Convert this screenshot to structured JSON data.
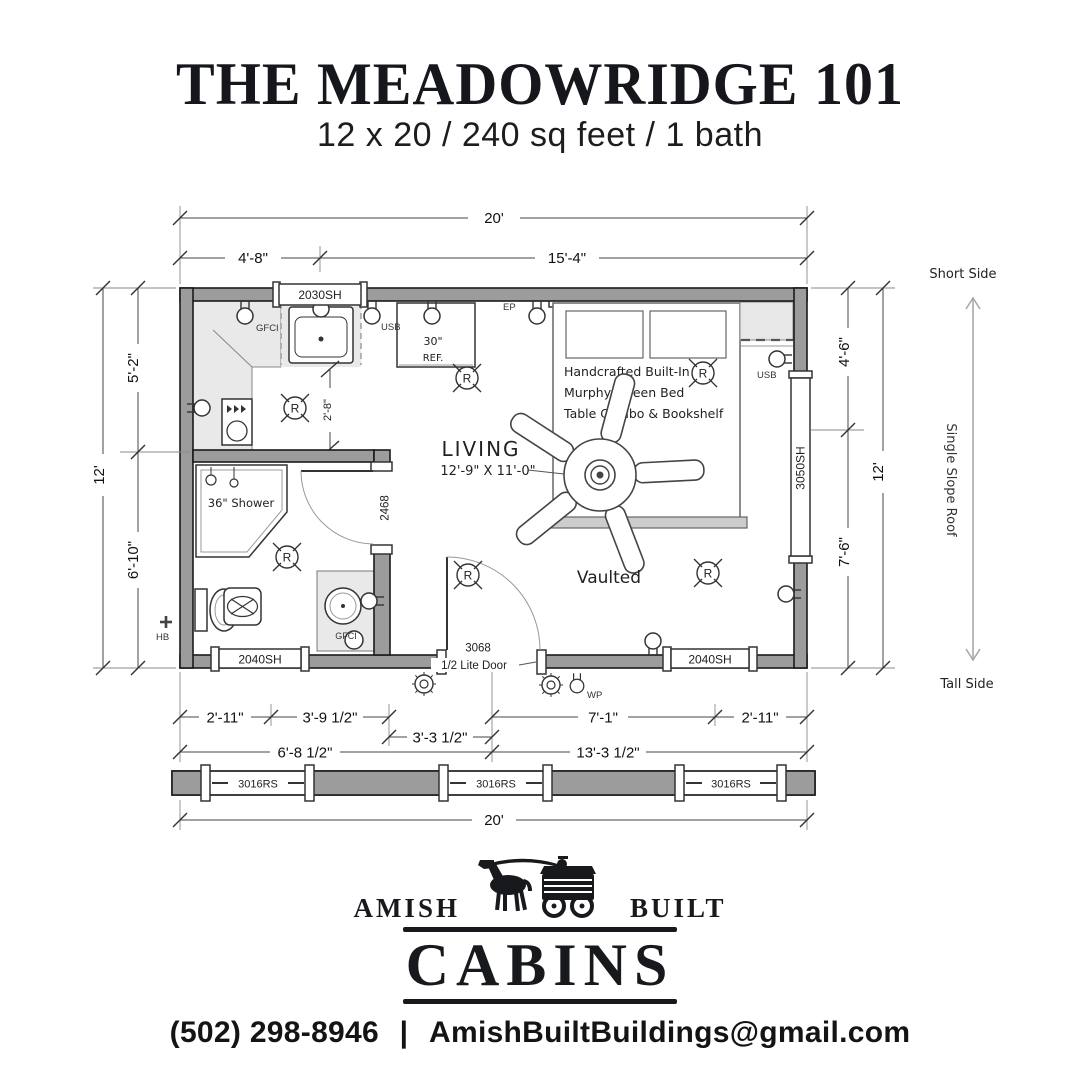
{
  "header": {
    "title": "THE MEADOWRIDGE 101",
    "subtitle": "12 x 20 / 240 sq feet / 1 bath"
  },
  "dimensions": {
    "top_total": "20'",
    "top_left": "4'-8\"",
    "top_right": "15'-4\"",
    "left_upper": "5'-2\"",
    "left_lower": "6'-10\"",
    "left_total": "12'",
    "right_upper": "4'-6\"",
    "right_lower": "7'-6\"",
    "right_total": "12'",
    "bottom_r1_1": "2'-11\"",
    "bottom_r1_2": "3'-9 1/2\"",
    "bottom_r1_3": "3'-3 1/2\"",
    "bottom_r1_4": "7'-1\"",
    "bottom_r1_5": "2'-11\"",
    "bottom_r2_1": "6'-8 1/2\"",
    "bottom_r2_2": "13'-3 1/2\"",
    "bottom_total": "20'",
    "counter_depth": "2'-8\""
  },
  "roof": {
    "short_side": "Short Side",
    "label": "Single Slope Roof",
    "tall_side": "Tall Side"
  },
  "windows": {
    "kitchen": "2030SH",
    "bedroom_right": "3050SH",
    "bottom": "2040SH",
    "elevation": "3016RS"
  },
  "doors": {
    "bathroom": "2468",
    "entry_number": "3068",
    "entry_type": "1/2 Lite Door"
  },
  "rooms": {
    "living_name": "LIVING",
    "living_size": "12'-9\" X 11'-0\"",
    "ceiling": "Vaulted",
    "shower": "36\" Shower",
    "fridge_width": "30\"",
    "fridge": "REF.",
    "bed_line1": "Handcrafted Built-In",
    "bed_line2": "Murphy Queen Bed",
    "bed_line3": "Table Combo & Bookshelf"
  },
  "electrical": {
    "gfci": "GFCI",
    "usb": "USB",
    "panel": "EP",
    "weatherproof": "WP",
    "hose_bib": "HB",
    "recessed": "R"
  },
  "colors": {
    "wall_gray": "#9c9c9c",
    "shading_gray": "#e9e9e9",
    "ink": "#17191d"
  },
  "logo": {
    "amish": "AMISH",
    "built": "BUILT",
    "cabins": "CABINS"
  },
  "contact": {
    "phone": "(502) 298-8946",
    "separator": "|",
    "email": "AmishBuiltBuildings@gmail.com"
  }
}
